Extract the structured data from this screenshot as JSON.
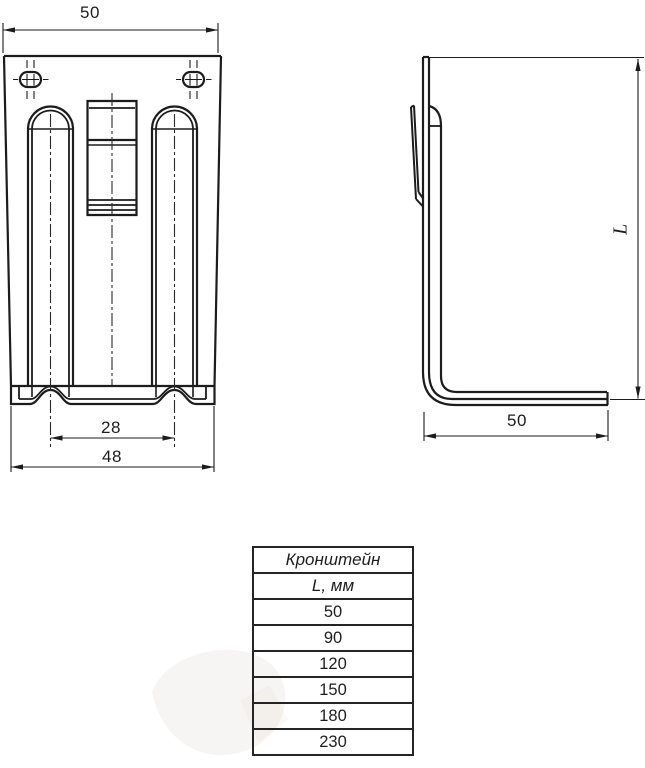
{
  "page": {
    "background": "#ffffff",
    "line_color": "#1c1c1c"
  },
  "dimensions": {
    "front_top_width": "50",
    "slot_center_spacing": "28",
    "front_bottom_width": "48",
    "side_leg_length": "50",
    "height_symbol": "L"
  },
  "table": {
    "title": "Кронштейн",
    "header": "L, мм",
    "rows": [
      "50",
      "90",
      "120",
      "150",
      "180",
      "230"
    ]
  }
}
